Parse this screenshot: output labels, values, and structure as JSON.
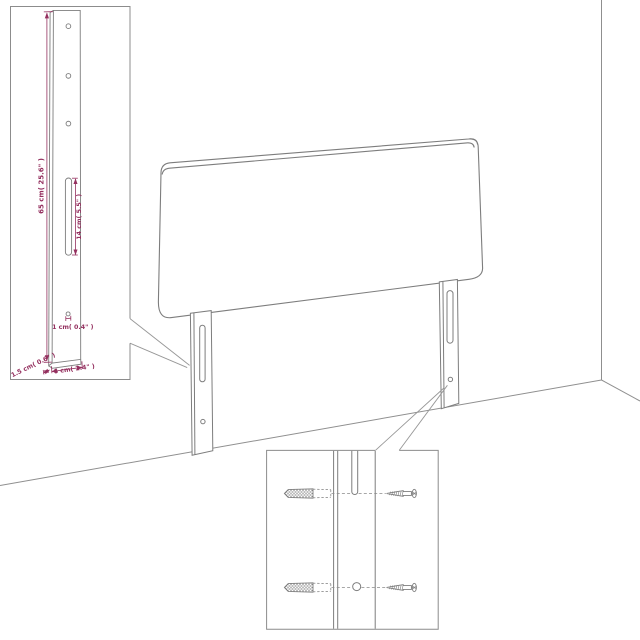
{
  "figure": {
    "insets": {
      "leg_detail": {
        "labels": {
          "height": "65 cm( 25.6\" )",
          "slot": "14 cm( 5.5\" )",
          "hole": "1 cm( 0.4\" )",
          "depth": "1.5 cm( 0.6\" )",
          "width": "6 cm( 2.4\" )"
        }
      }
    },
    "colors": {
      "dimension_text": "#94305f",
      "line_art": "#7d7d7d"
    }
  }
}
